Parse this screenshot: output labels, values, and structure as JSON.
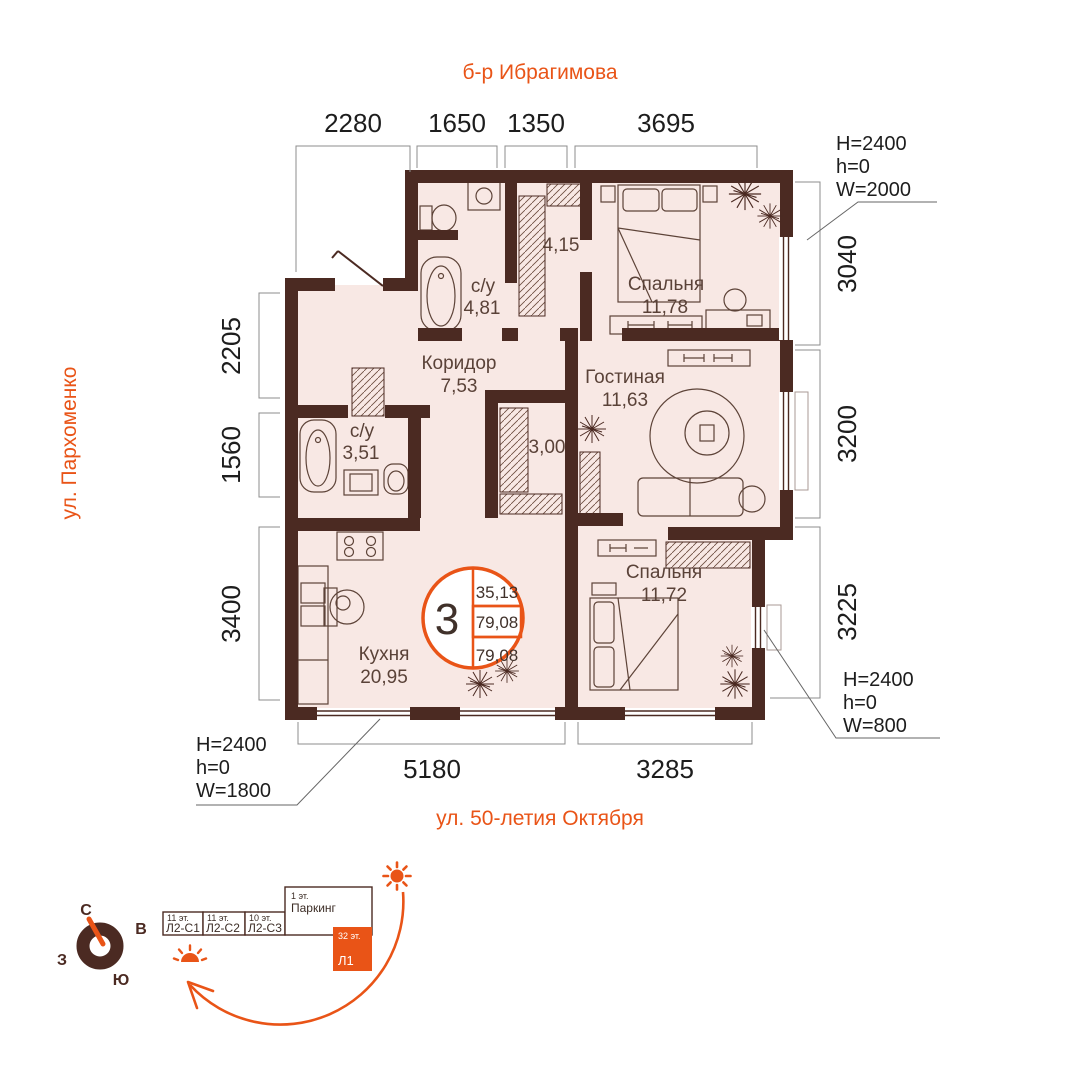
{
  "streets": {
    "top": "б-р Ибрагимова",
    "left": "ул. Пархоменко",
    "bottom": "ул. 50-летия Октября"
  },
  "dims": {
    "top": [
      "2280",
      "1650",
      "1350",
      "3695"
    ],
    "left": [
      "2205",
      "1560",
      "3400"
    ],
    "right": [
      "3040",
      "3200",
      "3225"
    ],
    "bottom": [
      "5180",
      "3285"
    ]
  },
  "rooms": {
    "bedroom1": {
      "name": "Спальня",
      "area": "11,78"
    },
    "living": {
      "name": "Гостиная",
      "area": "11,63"
    },
    "bedroom2": {
      "name": "Спальня",
      "area": "11,72"
    },
    "kitchen": {
      "name": "Кухня",
      "area": "20,95"
    },
    "hall": {
      "name": "Коридор",
      "area": "7,53"
    },
    "bath1": {
      "name": "с/у",
      "area": "4,81"
    },
    "bath2": {
      "name": "с/у",
      "area": "3,51"
    },
    "storage1": {
      "area": "4,15"
    },
    "storage2": {
      "area": "3,00"
    }
  },
  "badge": {
    "rooms": "3",
    "values": [
      "35,13",
      "79,08",
      "79,08"
    ]
  },
  "window_specs": {
    "top_right": {
      "H": "H=2400",
      "h": "h=0",
      "W": "W=2000"
    },
    "bottom_right": {
      "H": "H=2400",
      "h": "h=0",
      "W": "W=800"
    },
    "bottom_left": {
      "H": "H=2400",
      "h": "h=0",
      "W": "W=1800"
    }
  },
  "compass": {
    "north": "С",
    "east": "В",
    "south": "Ю",
    "west": "З"
  },
  "site_plan": {
    "buildings": [
      {
        "floors": "11 эт.",
        "label": "Л2-С1"
      },
      {
        "floors": "11 эт.",
        "label": "Л2-С2"
      },
      {
        "floors": "10 эт.",
        "label": "Л2-С3"
      },
      {
        "floors": "1 эт.",
        "label": "Паркинг"
      },
      {
        "floors": "32 эт.",
        "label": "Л1"
      }
    ]
  },
  "colors": {
    "accent": "#e95417",
    "wall": "#4b2a22",
    "floor": "#f8e8e4"
  }
}
